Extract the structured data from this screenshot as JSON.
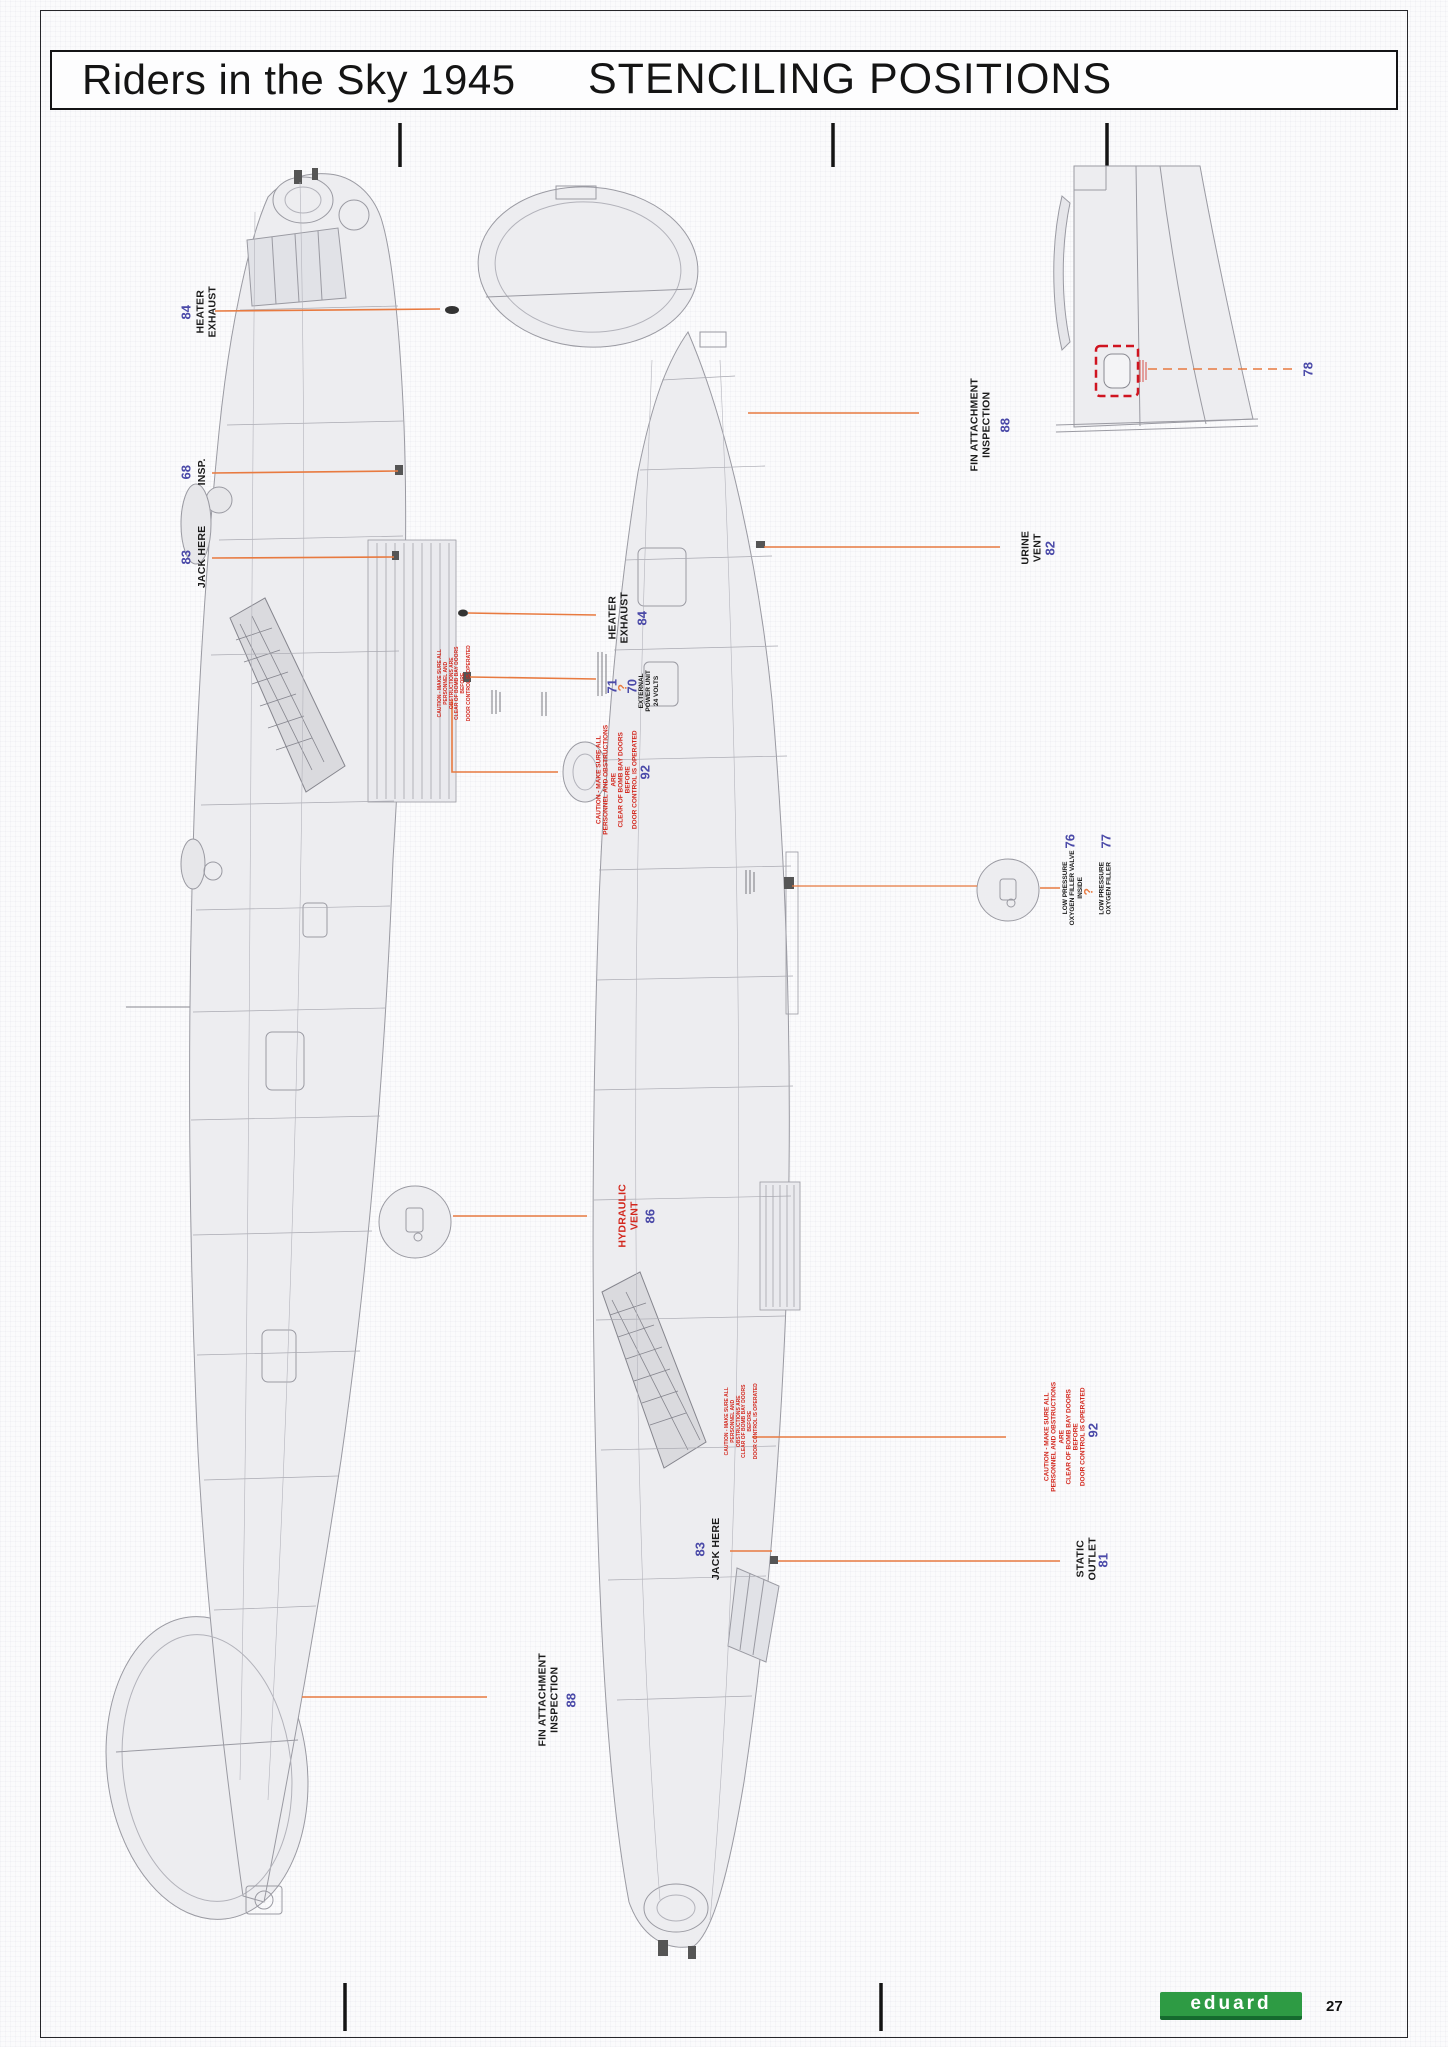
{
  "header": {
    "title": "Riders in the Sky 1945",
    "section": "STENCILING POSITIONS"
  },
  "footer": {
    "brand": "eduard",
    "page_number": "27"
  },
  "colors": {
    "leader_orange": "#E87A40",
    "stencil_number_blue": "#4A49A8",
    "warning_red": "#D2281E",
    "brand_green": "#2E9B44"
  },
  "stencils": {
    "heater_exhaust_top": {
      "num": "84",
      "text": "HEATER\nEXHAUST"
    },
    "insp": {
      "num": "68",
      "text": "INSP."
    },
    "jack_here_left": {
      "num": "83",
      "text": "JACK HERE"
    },
    "heater_exhaust_mid": {
      "num": "84",
      "text": "HEATER\nEXHAUST"
    },
    "external_power": {
      "num_71": "71",
      "unknown": "?",
      "num_70": "70",
      "text": "EXTERNAL\nPOWER UNIT\n24 VOLTS"
    },
    "caution_left": {
      "num": "92",
      "text": "CAUTION - MAKE SURE ALL\nPERSONNEL AND OBSTRUCTIONS ARE\nCLEAR OF BOMB BAY DOORS BEFORE\nDOOR CONTROL IS OPERATED"
    },
    "hydraulic_vent": {
      "num": "86",
      "text": "HYDRAULIC\nVENT"
    },
    "fin_attachment_left": {
      "num": "88",
      "text": "FIN  ATTACHMENT\nINSPECTION"
    },
    "fin_attachment_right": {
      "num": "88",
      "text": "FIN  ATTACHMENT\nINSPECTION"
    },
    "urine_vent": {
      "num": "82",
      "text": "URINE\nVENT"
    },
    "oxygen_76": {
      "num": "76",
      "unknown": "?",
      "text": "LOW PRESSURE\nOXYGEN FILLER VALVE\nINSIDE"
    },
    "oxygen_77": {
      "num": "77",
      "text": "LOW PRESSURE\nOXYGEN FILLER"
    },
    "caution_right": {
      "num": "92",
      "text": "CAUTION - MAKE SURE ALL\nPERSONNEL AND OBSTRUCTIONS ARE\nCLEAR OF BOMB BAY DOORS BEFORE\nDOOR CONTROL IS OPERATED"
    },
    "jack_here_right": {
      "num": "83",
      "text": "JACK HERE"
    },
    "static_outlet": {
      "num": "81",
      "text": "STATIC\nOUTLET"
    },
    "fin_window": {
      "num": "78"
    }
  }
}
